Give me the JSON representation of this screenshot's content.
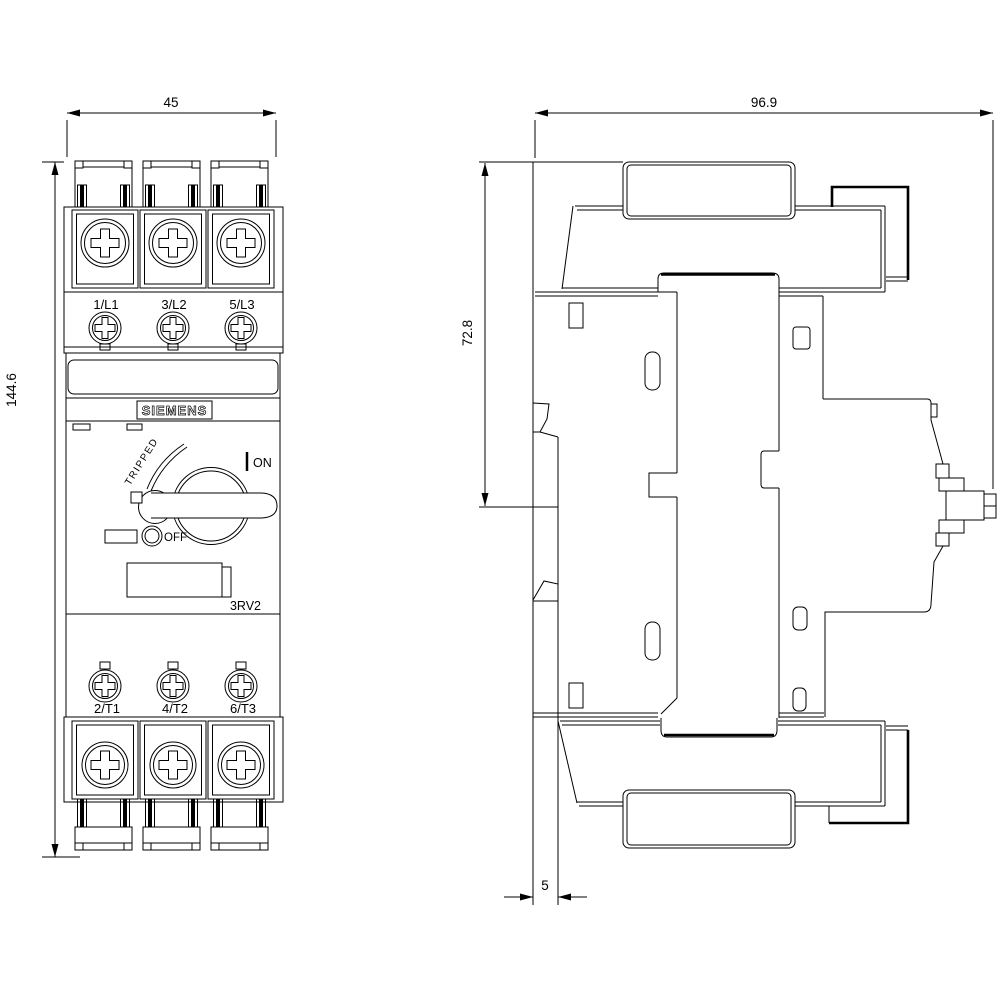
{
  "brand": "SIEMENS",
  "model": "3RV2",
  "dims": {
    "width": "45",
    "height": "144.6",
    "depth": "96.9",
    "upper_height": "72.8",
    "rail_offset": "5"
  },
  "front": {
    "top_terminals": [
      "1/L1",
      "3/L2",
      "5/L3"
    ],
    "bottom_terminals": [
      "2/T1",
      "4/T2",
      "6/T3"
    ]
  },
  "switch": {
    "tripped": "TRIPPED",
    "on": "ON",
    "off": "OFF"
  },
  "colors": {
    "line": "#000000",
    "bg": "#ffffff"
  }
}
